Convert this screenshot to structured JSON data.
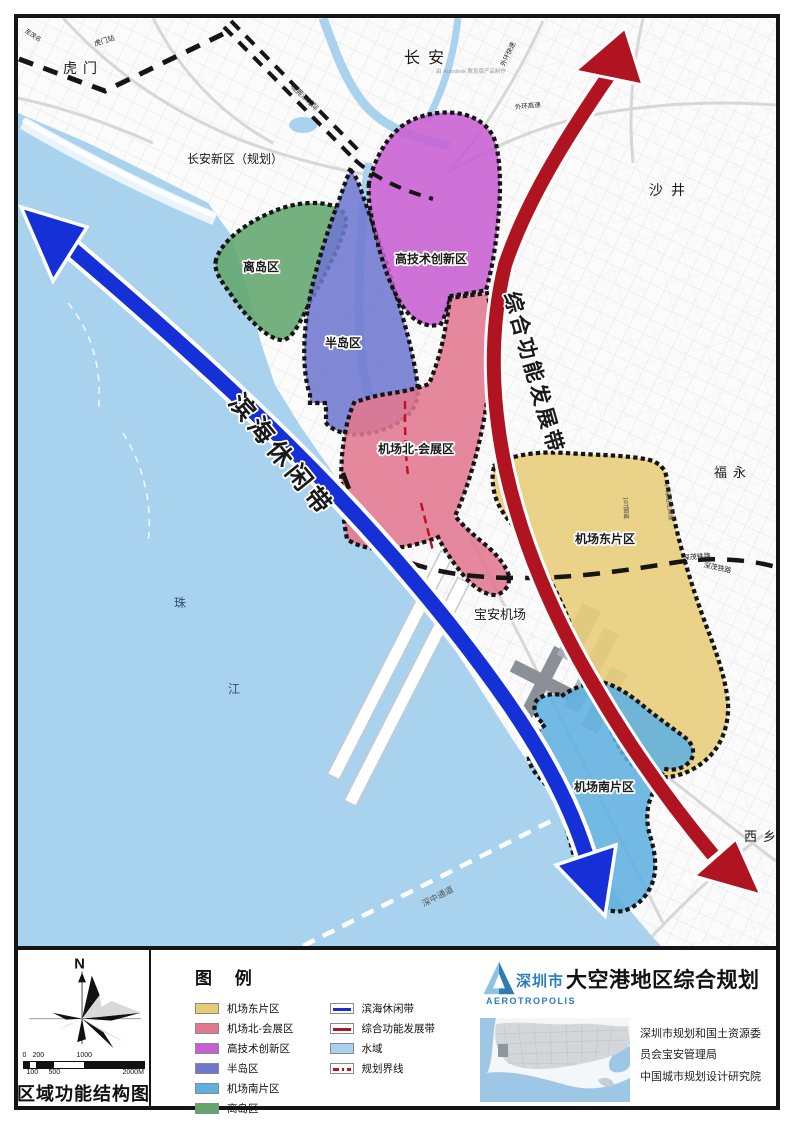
{
  "colors": {
    "water": "#a8d2ee",
    "land": "#fbfbfb",
    "island": "#62a66c",
    "peninsula": "#7077cf",
    "hightech": "#c75ed3",
    "airport_north": "#e27890",
    "airport_east": "#e7cc77",
    "airport_south": "#5fb0e0",
    "coastal_belt": "#1430d6",
    "development_belt": "#b01420",
    "boundary_red": "#c01220",
    "rail": "#151515"
  },
  "map": {
    "labels": [
      {
        "id": "changan",
        "t": "长安",
        "x": 425,
        "y": 60,
        "s": 16,
        "ls": 8
      },
      {
        "id": "autodesk-note",
        "t": "由 Autodesk 教育版产品制作",
        "x": 468,
        "y": 70,
        "s": 5.5,
        "f": "#9a9a9a"
      },
      {
        "id": "humen",
        "t": "虎门",
        "x": 80,
        "y": 70,
        "s": 14,
        "ls": 6
      },
      {
        "id": "humen-station",
        "t": "虎门站",
        "x": 102,
        "y": 40,
        "s": 7,
        "r": -18,
        "f": "#222"
      },
      {
        "id": "to-maoming",
        "t": "至茂名",
        "x": 29,
        "y": 34,
        "s": 6,
        "r": 33,
        "f": "#222"
      },
      {
        "id": "suiguan-rail",
        "t": "穗莞深城际",
        "x": 300,
        "y": 96,
        "s": 7,
        "r": 43,
        "f": "#222"
      },
      {
        "id": "changan-new-area",
        "t": "长安新区（规划）",
        "x": 232,
        "y": 160,
        "s": 12
      },
      {
        "id": "shajing",
        "t": "沙井",
        "x": 668,
        "y": 192,
        "s": 14,
        "ls": 8
      },
      {
        "id": "fuyong",
        "t": "福永",
        "x": 730,
        "y": 474,
        "s": 13,
        "ls": 6
      },
      {
        "id": "xixiang",
        "t": "西乡",
        "x": 760,
        "y": 838,
        "s": 13,
        "ls": 6
      },
      {
        "id": "zhu",
        "t": "珠",
        "x": 177,
        "y": 604,
        "s": 12,
        "f": "#2e4f6e"
      },
      {
        "id": "jiang",
        "t": "江",
        "x": 231,
        "y": 690,
        "s": 12,
        "f": "#2e4f6e"
      },
      {
        "id": "baoan-airport",
        "t": "宝安机场",
        "x": 497,
        "y": 616,
        "s": 13,
        "halo": true
      },
      {
        "id": "zone-island",
        "t": "离岛区",
        "x": 258,
        "y": 268,
        "s": 12,
        "w": "bold",
        "halo": true
      },
      {
        "id": "zone-peninsula",
        "t": "半岛区",
        "x": 340,
        "y": 344,
        "s": 12,
        "w": "bold",
        "halo": true
      },
      {
        "id": "zone-hightech",
        "t": "高技术创新区",
        "x": 428,
        "y": 260,
        "s": 12,
        "w": "bold",
        "halo": true
      },
      {
        "id": "zone-airport-north",
        "t": "机场北-会展区",
        "x": 413,
        "y": 450,
        "s": 12,
        "w": "bold",
        "halo": true
      },
      {
        "id": "zone-airport-east",
        "t": "机场东片区",
        "x": 602,
        "y": 540,
        "s": 12,
        "w": "bold",
        "halo": true
      },
      {
        "id": "zone-airport-south",
        "t": "机场南片区",
        "x": 601,
        "y": 788,
        "s": 12,
        "w": "bold",
        "halo": true
      },
      {
        "id": "belt-coastal",
        "t": "滨海休闲带",
        "x": 272,
        "y": 458,
        "s": 25,
        "r": 51,
        "ls": 5,
        "w": "bold",
        "halo": true
      },
      {
        "id": "belt-development",
        "t": "综合功能发展带",
        "x": 524,
        "y": 372,
        "s": 21,
        "r": 74,
        "ls": 3,
        "w": "bold",
        "halo": true
      },
      {
        "id": "shenmao-rail-1",
        "t": "深茂铁路",
        "x": 694,
        "y": 556,
        "s": 7,
        "r": -4,
        "f": "#222"
      },
      {
        "id": "shenmao-rail-2",
        "t": "深茂铁路",
        "x": 714,
        "y": 567,
        "s": 7,
        "r": 12,
        "f": "#222"
      },
      {
        "id": "shenzhong-corridor",
        "t": "深中通道",
        "x": 436,
        "y": 896,
        "s": 8.5,
        "r": -27,
        "f": "#555"
      },
      {
        "id": "waihuan-express",
        "t": "外环快速",
        "x": 507,
        "y": 52,
        "s": 6.5,
        "r": -65,
        "f": "#222"
      },
      {
        "id": "waihuan-highway",
        "t": "外环高速",
        "x": 525,
        "y": 105,
        "s": 6.5,
        "r": -6,
        "f": "#222"
      },
      {
        "id": "g107",
        "t": "107国道",
        "x": 621,
        "y": 505,
        "s": 6,
        "r": 88,
        "f": "#444"
      },
      {
        "id": "yanjiang-highway",
        "t": "广深沿江高速",
        "x": 664,
        "y": 500,
        "s": 6,
        "r": 82,
        "f": "#444"
      }
    ]
  },
  "panel": {
    "north": "N",
    "title": "区域功能结构图",
    "legend_title": "图 例",
    "legend_zones": [
      {
        "key": "airport_east",
        "label": "机场东片区"
      },
      {
        "key": "airport_north",
        "label": "机场北-会展区"
      },
      {
        "key": "hightech",
        "label": "高技术创新区"
      },
      {
        "key": "peninsula",
        "label": "半岛区"
      },
      {
        "key": "airport_south",
        "label": "机场南片区"
      },
      {
        "key": "island",
        "label": "离岛区"
      }
    ],
    "legend_lines": [
      {
        "key": "coastal_belt",
        "type": "line",
        "label": "滨海休闲带"
      },
      {
        "key": "development_belt",
        "type": "line",
        "label": "综合功能发展带"
      },
      {
        "key": "water",
        "type": "fill",
        "label": "水域"
      },
      {
        "key": "boundary_red",
        "type": "dash",
        "label": "规划界线"
      }
    ],
    "scale": {
      "top": [
        "0",
        "200",
        "1000"
      ],
      "bottom": [
        "100",
        "500",
        "2000M"
      ]
    },
    "logo": {
      "city": "深圳市",
      "title": "大空港地区综合规划",
      "latin": "AEROTROPOLIS"
    },
    "credits": [
      "深圳市规划和国土资源委",
      "员会宝安管理局",
      "中国城市规划设计研究院"
    ]
  }
}
